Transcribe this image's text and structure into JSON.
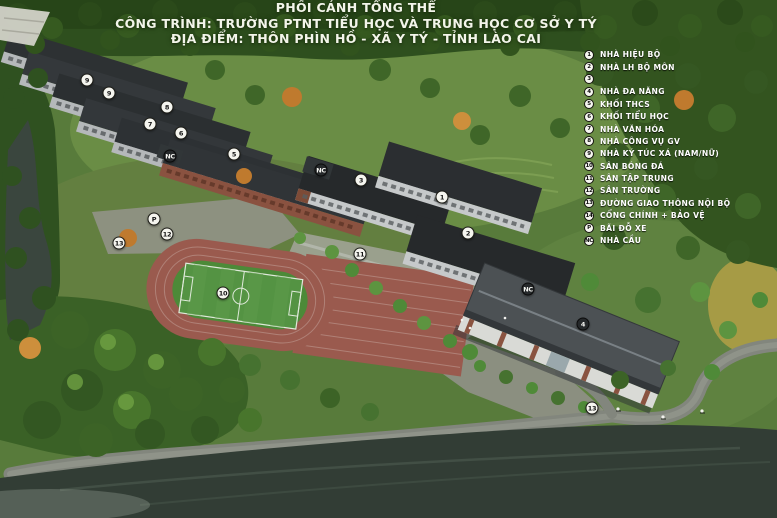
{
  "title": {
    "line1": "PHỐI CẢNH TỔNG THỂ",
    "line2": "CÔNG TRÌNH: TRƯỜNG PTNT TIỂU HỌC VÀ TRUNG HỌC CƠ SỞ Y TÝ",
    "line3": "ĐỊA ĐIỂM: THÔN PHÌN HỒ - XÃ Y TÝ - TỈNH LÀO CAI"
  },
  "legend": {
    "items": [
      {
        "badge": "1",
        "label": "NHÀ HIỆU BỘ"
      },
      {
        "badge": "2",
        "label": "NHÀ LH BỘ MÔN"
      },
      {
        "badge": "3",
        "label": ""
      },
      {
        "badge": "4",
        "label": "NHÀ ĐA NĂNG"
      },
      {
        "badge": "5",
        "label": "KHỐI THCS"
      },
      {
        "badge": "6",
        "label": "KHỐI TIỂU HỌC"
      },
      {
        "badge": "7",
        "label": "NHÀ VĂN HÓA"
      },
      {
        "badge": "8",
        "label": "NHÀ CÔNG VỤ GV"
      },
      {
        "badge": "9",
        "label": "NHÀ KÝ TÚC XÁ (NAM/NỮ)"
      },
      {
        "badge": "10",
        "label": "SÂN BÓNG ĐÁ"
      },
      {
        "badge": "11",
        "label": "SÂN TẬP TRUNG"
      },
      {
        "badge": "12",
        "label": "SÂN TRƯỜNG"
      },
      {
        "badge": "13",
        "label": "ĐƯỜNG GIAO THÔNG NỘI BỘ"
      },
      {
        "badge": "14",
        "label": "CỔNG CHÍNH + BẢO VỆ"
      },
      {
        "badge": "P",
        "label": "BÃI ĐỖ XE"
      },
      {
        "badge": "NC",
        "label": "NHÀ CẦU"
      }
    ]
  },
  "markers": [
    {
      "label": "9",
      "x": 87,
      "y": 80
    },
    {
      "label": "9",
      "x": 109,
      "y": 93
    },
    {
      "label": "8",
      "x": 167,
      "y": 107
    },
    {
      "label": "7",
      "x": 150,
      "y": 124
    },
    {
      "label": "6",
      "x": 181,
      "y": 133
    },
    {
      "label": "NC",
      "x": 170,
      "y": 156,
      "variant": "dark"
    },
    {
      "label": "5",
      "x": 234,
      "y": 154
    },
    {
      "label": "NC",
      "x": 321,
      "y": 170,
      "variant": "dark"
    },
    {
      "label": "3",
      "x": 361,
      "y": 180
    },
    {
      "label": "1",
      "x": 442,
      "y": 197
    },
    {
      "label": "2",
      "x": 468,
      "y": 233
    },
    {
      "label": "P",
      "x": 154,
      "y": 219
    },
    {
      "label": "12",
      "x": 167,
      "y": 234
    },
    {
      "label": "13",
      "x": 119,
      "y": 243
    },
    {
      "label": "11",
      "x": 360,
      "y": 254
    },
    {
      "label": "10",
      "x": 223,
      "y": 293
    },
    {
      "label": "NC",
      "x": 528,
      "y": 289,
      "variant": "dark"
    },
    {
      "label": "4",
      "x": 583,
      "y": 324,
      "variant": "dark"
    },
    {
      "label": "13",
      "x": 592,
      "y": 408
    }
  ],
  "colors": {
    "title_text": "#f3f5ea",
    "legend_text": "#ffffff",
    "marker_light_bg": "#f5f5ef",
    "marker_dark_bg": "#26292b",
    "forest_dark": "#2e4f1e",
    "hill_green": "#6a8d45",
    "river_water": "#343f37",
    "running_track": "#9a5a4e",
    "soccer_field": "#549343",
    "roof_dark": "#26292b",
    "roof_hall": "#4c5154",
    "road_gray": "#82867d",
    "brick": "#7d4b37"
  }
}
